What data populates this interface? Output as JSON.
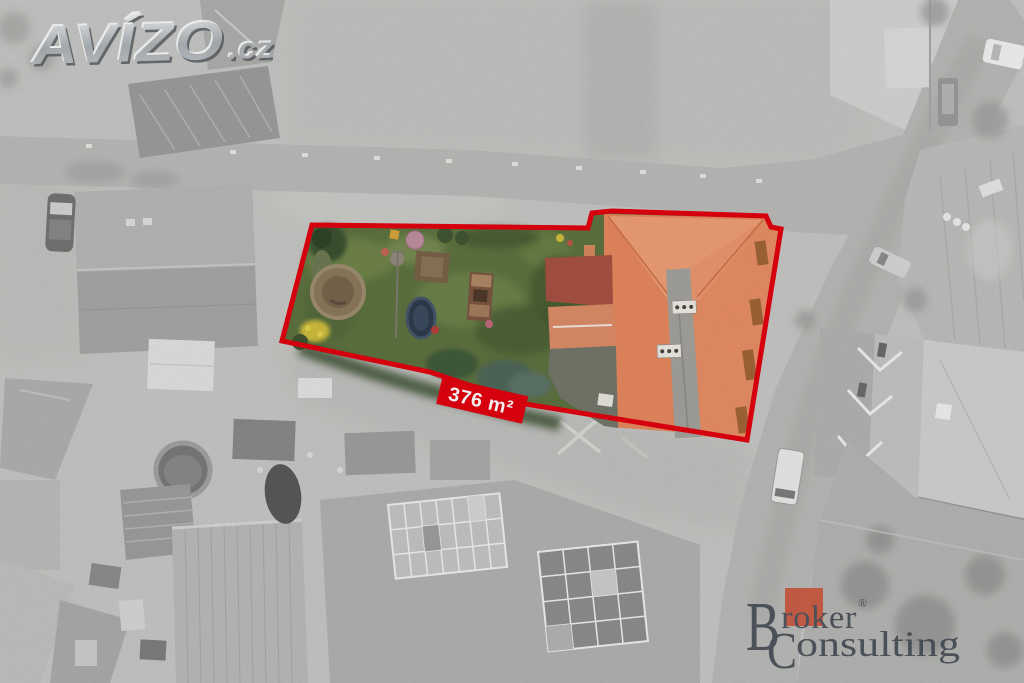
{
  "watermark": {
    "brand": "AVÍZO",
    "suffix": ".cz"
  },
  "area_label": {
    "text": "376 m²"
  },
  "broker_logo": {
    "initial1": "B",
    "rest1": "roker",
    "registered": "®",
    "initial2": "C",
    "rest2": "onsulting"
  },
  "colors": {
    "boundary_red": "#e3000f",
    "label_red": "#e3000f",
    "roof_orange": "#e8895f",
    "garden_green": "#5e7340",
    "logo_square": "#c4492f",
    "logo_text": "#394049"
  }
}
